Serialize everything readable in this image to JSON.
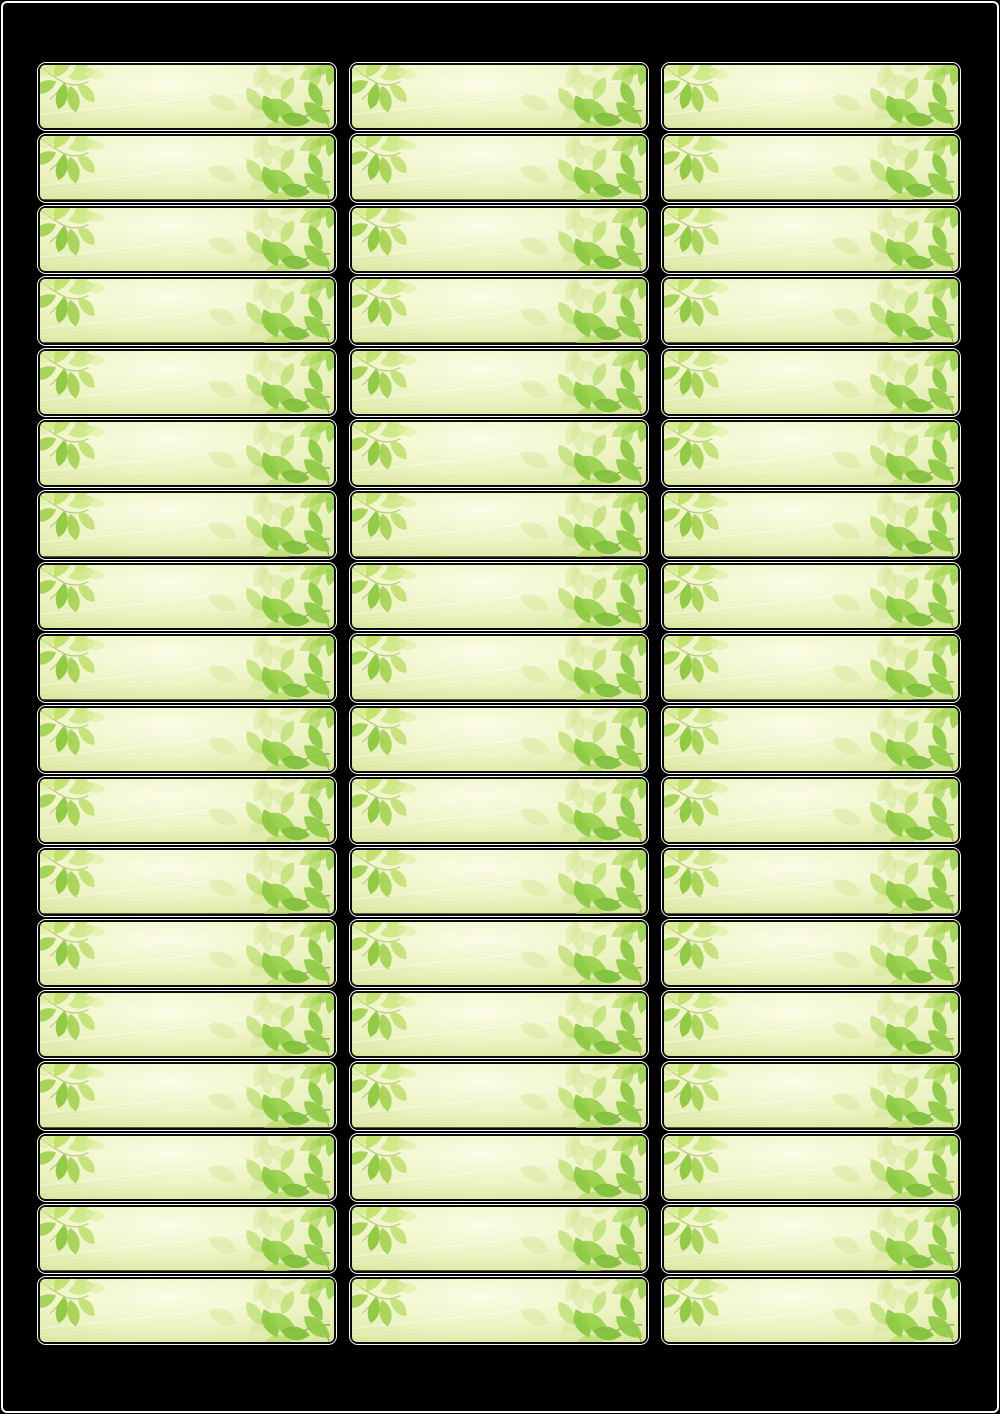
{
  "page": {
    "title": "Blank address label sheet template with green leaf design",
    "background_color": "#000000",
    "frame_color": "#ffffff"
  },
  "sheet": {
    "columns": 3,
    "rows": 18,
    "label_count": 54
  },
  "label": {
    "content_text": "",
    "ornament": "green-leaf-branches",
    "style": {
      "outline_color": "#fafafa",
      "border_color": "#0d0d0d",
      "gradient_center": "#fbfce6",
      "gradient_mid": "#eef4c5",
      "gradient_edge": "#d6e59a",
      "swoosh_color": "#ffffff",
      "stem_color": "#a9bf6b",
      "leaf_palette": [
        "#7dbf38",
        "#8bc841",
        "#98d04b",
        "#a6d456",
        "#b5dc66",
        "#c8e474",
        "#cde886",
        "#d8ec9c",
        "#cfe48e"
      ]
    }
  }
}
